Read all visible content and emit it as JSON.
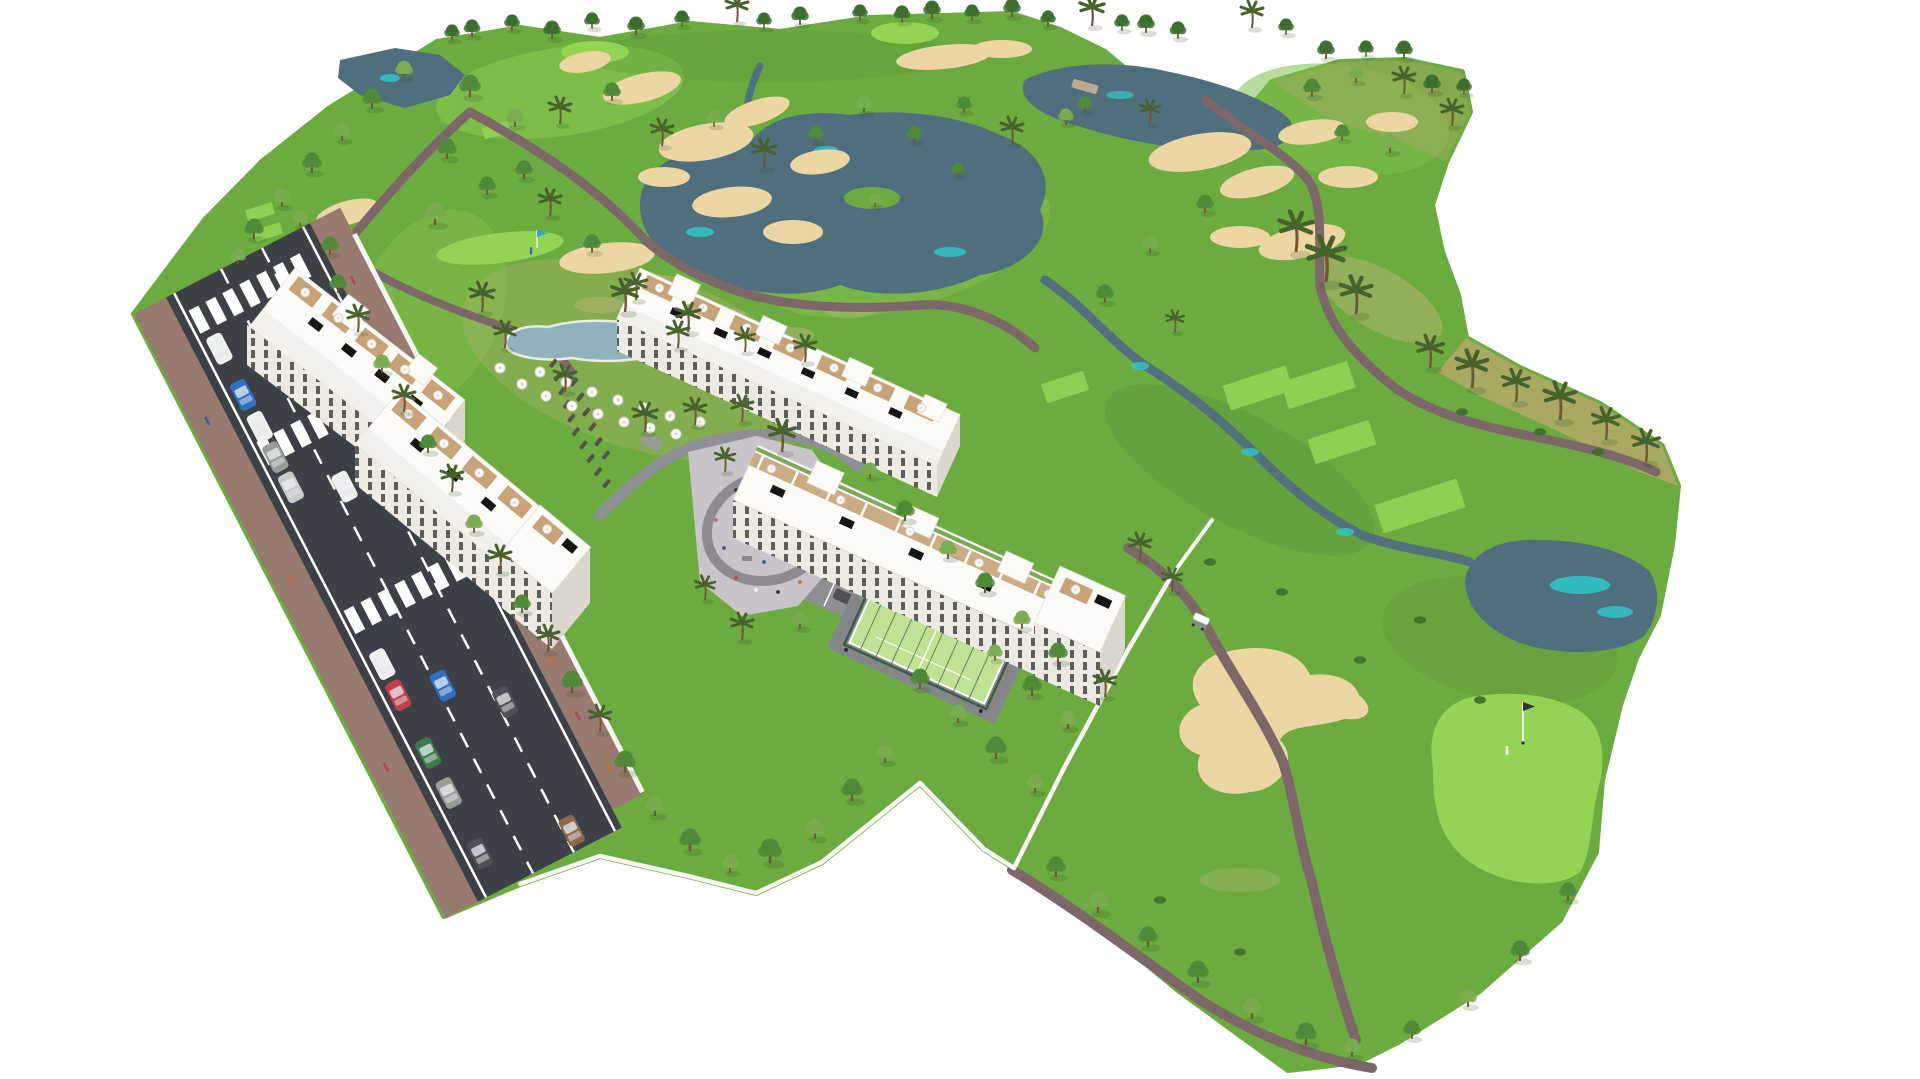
{
  "meta": {
    "kind": "architectural-aerial-render",
    "title_hidden": ""
  },
  "scene": {
    "description": "Aerial 3D architectural rendering of a white low-rise apartment complex with rooftop terraces beside a golf course. The golf course has ponds with turquoise accents, sand bunkers, winding mauve cart paths, bright tee boxes and putting greens with flags. The residential complex includes a lagoon-style pool with white parasols and sun loungers, a paved playground plaza, a fenced padel court, gardens with palms, and a perimeter road with parked cars, crosswalks and pedestrians. Background is plain white.",
    "elements": [
      {
        "name": "golf-course",
        "description": "Rolling green fairways with lighter mown areas and dry scrub band on the right"
      },
      {
        "name": "ponds",
        "description": "Slate blue-grey water bodies with turquoise shallows"
      },
      {
        "name": "sand-bunkers",
        "description": "Tan irregular sand traps scattered across the course"
      },
      {
        "name": "cart-paths",
        "description": "Mauve-brown winding golf cart paths"
      },
      {
        "name": "apartment-blocks",
        "description": "Four white apartment rows with roof terraces, parasols and solar panels"
      },
      {
        "name": "swimming-pool",
        "description": "Lagoon-shaped grey-blue pool with beach entry, parasols and loungers"
      },
      {
        "name": "putting-greens",
        "description": "Bright green circles with flag pins and tiny golfers"
      },
      {
        "name": "playground-plaza",
        "description": "Light grey paved plaza with loop path, play equipment and people"
      },
      {
        "name": "padel-court",
        "description": "Light green fenced padel court with white lines"
      },
      {
        "name": "road",
        "description": "Dark asphalt road with dashed white lane lines, zebra crossings, parked and moving cars, brick sidewalks"
      },
      {
        "name": "golf-cart",
        "description": "White golf buggy on the east cart path"
      },
      {
        "name": "perimeter-wall",
        "description": "Low white boundary walls around the residence gardens"
      },
      {
        "name": "trees",
        "description": "Round green trees and olive palm trees, with a tree row along the horizon"
      }
    ]
  },
  "palette": {
    "background": "#ffffff",
    "fairway": "#6cab40",
    "fairwayLight": "#80c04c",
    "brightGreen": "#93d455",
    "teeGreen": "#8ed054",
    "roughDark": "#589538",
    "scrubDry": "#a9a962",
    "dryPatch": "#b9b474",
    "sand": "#ecd7a4",
    "waterDark": "#4f6f7e",
    "waterCyan": "#2fc8c9",
    "streamBlue": "#53707f",
    "pathMauve": "#7e6769",
    "roadAsphalt": "#3d4147",
    "roadMarking": "#ffffff",
    "sidewalkBrick": "#997a70",
    "wallWhite": "#f7f6f3",
    "buildingWhite": "#fcfbf8",
    "buildingShade": "#dbd7cf",
    "facadeShade": "#eceae3",
    "windowDark": "#3b3b38",
    "woodTan": "#c7a377",
    "terraceTan": "#b99b72",
    "solarBlack": "#151515",
    "umbrellaWhite": "#f6f5f1",
    "poolWater": "#8fb2bc",
    "poolRim": "#eceae2",
    "plazaGray": "#c9c4ca",
    "plazaLoop": "#8f8a92",
    "drivewayGray": "#8f9094",
    "padelGreen": "#c1e294",
    "padelFence": "#3c5c46",
    "treeDark": "#3c6e2f",
    "treeMid": "#4f8a38",
    "treeLight": "#7aad50",
    "treeYellow": "#9cc469",
    "palmGreen": "#47632d",
    "trunkBrown": "#6e5638",
    "shadowGreen": "#2e4f23",
    "carWhite": "#f0f0ee",
    "carRed": "#c03f4a",
    "carBlue": "#2f6fc4",
    "carTeal": "#2fa6c0",
    "carGreen": "#3d7a4b",
    "carGray": "#9a9a98",
    "carSilver": "#c9c9c7",
    "carDark": "#4e5257",
    "carBrown": "#8a6a4a",
    "personOrange": "#c3703f",
    "flagBlue": "#2aa7d8",
    "flagDark": "#333333"
  }
}
